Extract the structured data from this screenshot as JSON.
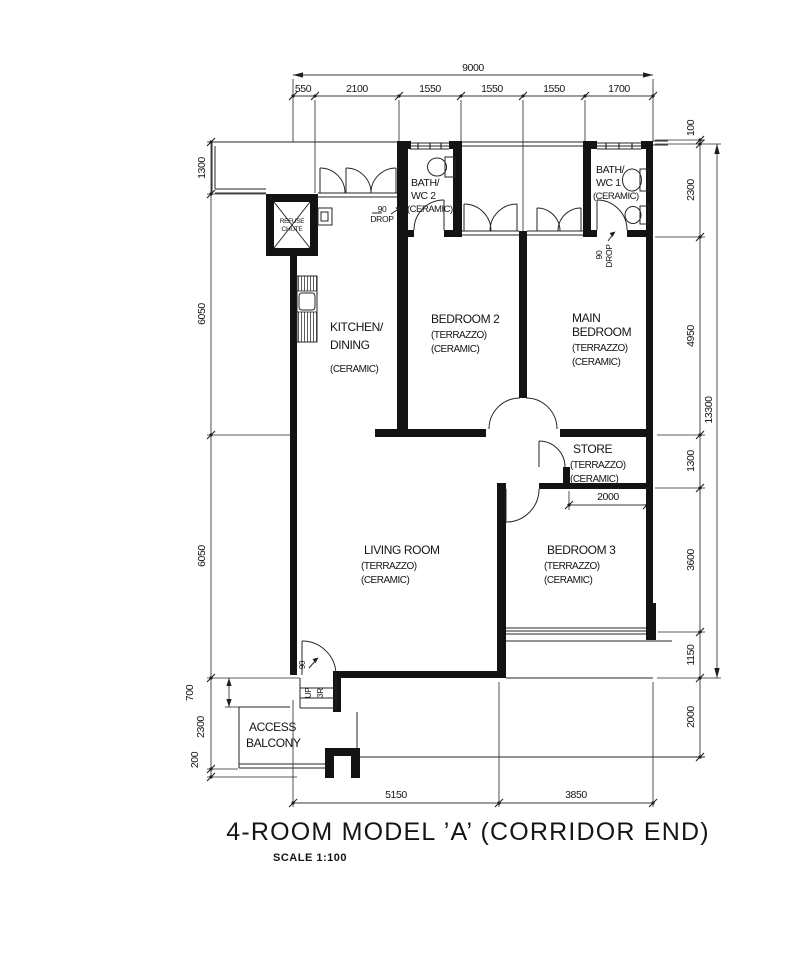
{
  "drawing": {
    "title": "4-ROOM MODEL ’A’ (CORRIDOR END)",
    "scale": "SCALE  1:100"
  },
  "dims": {
    "top_total": "9000",
    "top": [
      "550",
      "2100",
      "1550",
      "1550",
      "1550",
      "1700"
    ],
    "right": [
      "100",
      "2300",
      "4950",
      "1300",
      "3600",
      "1150",
      "2000"
    ],
    "right_total": "13300",
    "left": [
      "1300",
      "6050",
      "6050",
      "700",
      "2300",
      "200"
    ],
    "bottom": [
      "5150",
      "3850"
    ],
    "store_width": "2000"
  },
  "rooms": {
    "kitchen": {
      "l1": "KITCHEN/",
      "l2": "DINING",
      "f1": "(CERAMIC)"
    },
    "bedroom2": {
      "l1": "BEDROOM 2",
      "f1": "(TERRAZZO)",
      "f2": "(CERAMIC)"
    },
    "main_bedroom": {
      "l1": "MAIN",
      "l2": "BEDROOM",
      "f1": "(TERRAZZO)",
      "f2": "(CERAMIC)"
    },
    "bath2": {
      "l1": "BATH/",
      "l2": "WC 2",
      "f1": "(CERAMIC)"
    },
    "bath1": {
      "l1": "BATH/",
      "l2": "WC 1",
      "f1": "(CERAMIC)"
    },
    "store": {
      "l1": "STORE",
      "f1": "(TERRAZZO)",
      "f2": "(CERAMIC)"
    },
    "living": {
      "l1": "LIVING ROOM",
      "f1": "(TERRAZZO)",
      "f2": "(CERAMIC)"
    },
    "bedroom3": {
      "l1": "BEDROOM 3",
      "f1": "(TERRAZZO)",
      "f2": "(CERAMIC)"
    },
    "balcony": {
      "l1": "ACCESS",
      "l2": "BALCONY"
    }
  },
  "ann": {
    "refuse_l1": "REFUSE",
    "refuse_l2": "CHUTE",
    "drop2_l1": "90",
    "drop2_l2": "DROP",
    "drop1_l1": "90",
    "drop1_l2": "DROP",
    "up": "UP",
    "risers": "3R",
    "step_drop": "90"
  }
}
